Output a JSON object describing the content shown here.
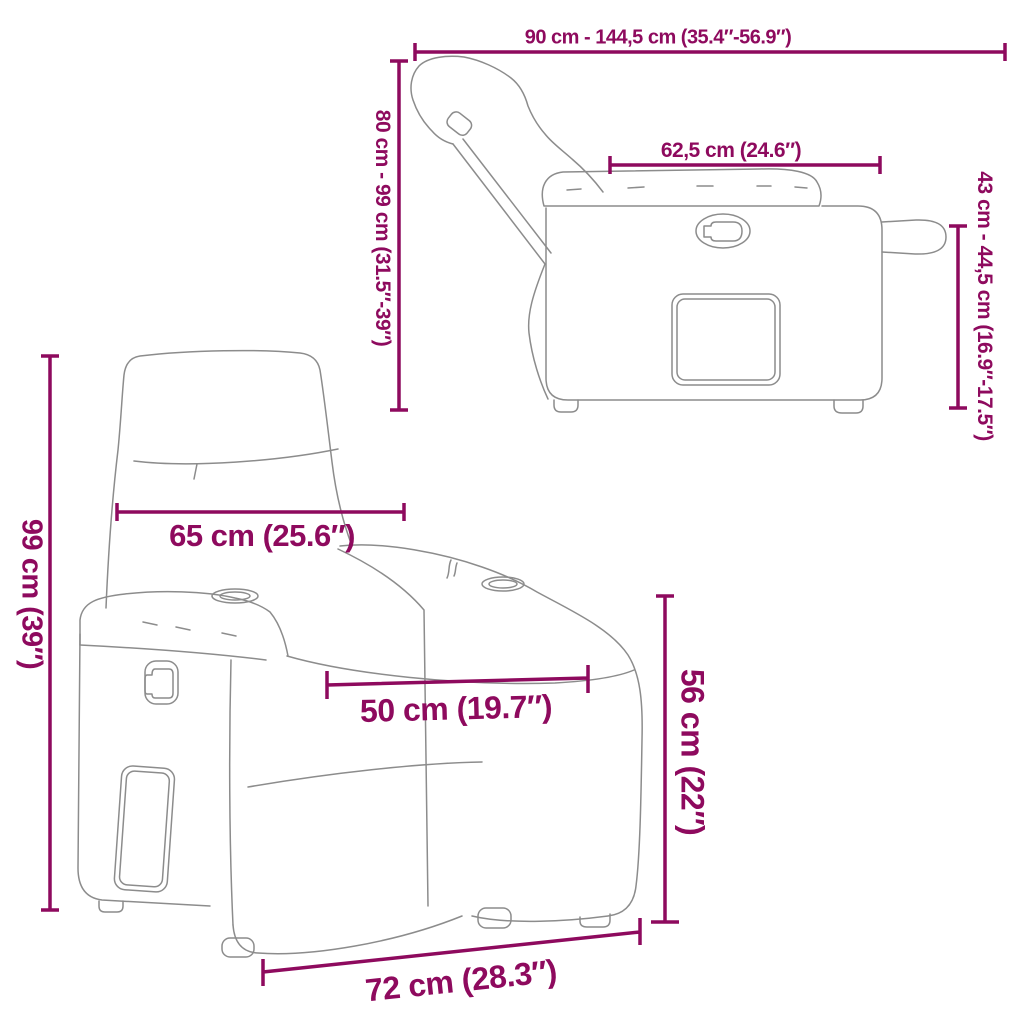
{
  "colors": {
    "dimension": "#8E0A5E",
    "outline": "#8C8C8C",
    "background": "#ffffff"
  },
  "views": {
    "side_reclined": {
      "name": "recliner side view reclined"
    },
    "front": {
      "name": "recliner front view"
    }
  },
  "dimensions": {
    "total_depth_range": {
      "label": "90 cm - 144,5 cm (35.4″-56.9″)"
    },
    "back_height_range": {
      "label": "80 cm - 99 cm (31.5″-39″)"
    },
    "armrest_depth": {
      "label": "62,5 cm (24.6″)"
    },
    "footrest_height_range": {
      "label": "43 cm - 44,5 cm (16.9″-17.5″)"
    },
    "back_width": {
      "label": "65 cm (25.6″)"
    },
    "total_height": {
      "label": "99 cm (39″)"
    },
    "seat_width": {
      "label": "50 cm (19.7″)"
    },
    "seat_height": {
      "label": "56 cm (22″)"
    },
    "base_width": {
      "label": "72 cm (28.3″)"
    }
  }
}
